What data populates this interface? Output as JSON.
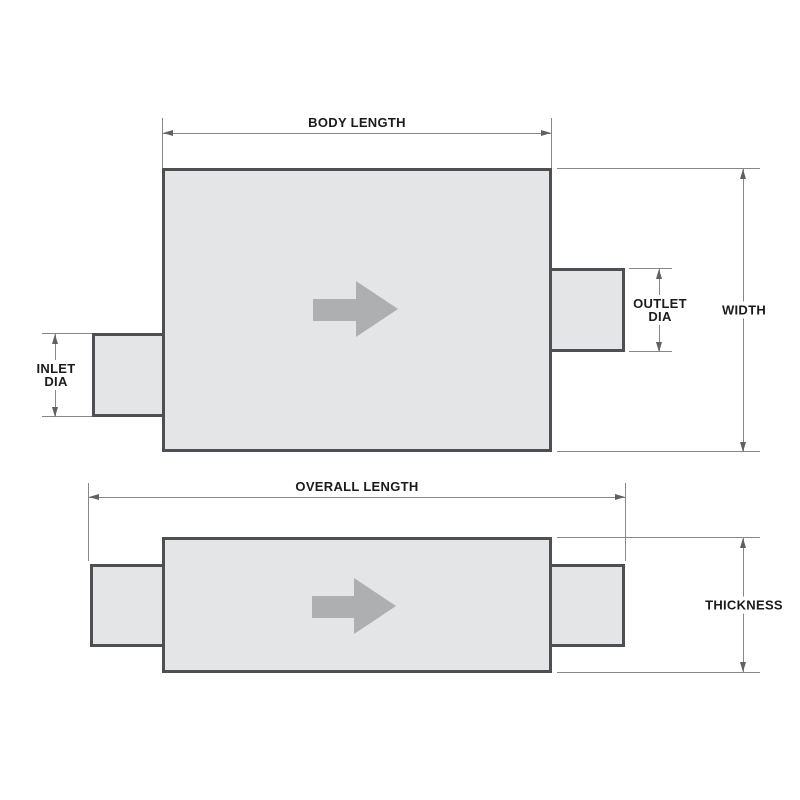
{
  "diagram": {
    "colors": {
      "background": "#ffffff",
      "shape_fill": "#e3e5e7",
      "shape_border": "#4d4f52",
      "dimension_line": "#85878a",
      "arrowhead": "#5f6163",
      "flow_arrow": "#adafb1",
      "label_text": "#1b1b1b"
    },
    "top_view": {
      "labels": {
        "body_length": "BODY LENGTH",
        "width": "WIDTH",
        "outlet_dia": [
          "OUTLET",
          "DIA"
        ],
        "inlet_dia": [
          "INLET",
          "DIA"
        ]
      },
      "flow_icon": "flow-direction-right-arrow"
    },
    "side_view": {
      "labels": {
        "overall_length": "OVERALL LENGTH",
        "thickness": "THICKNESS"
      },
      "flow_icon": "flow-direction-right-arrow"
    }
  }
}
